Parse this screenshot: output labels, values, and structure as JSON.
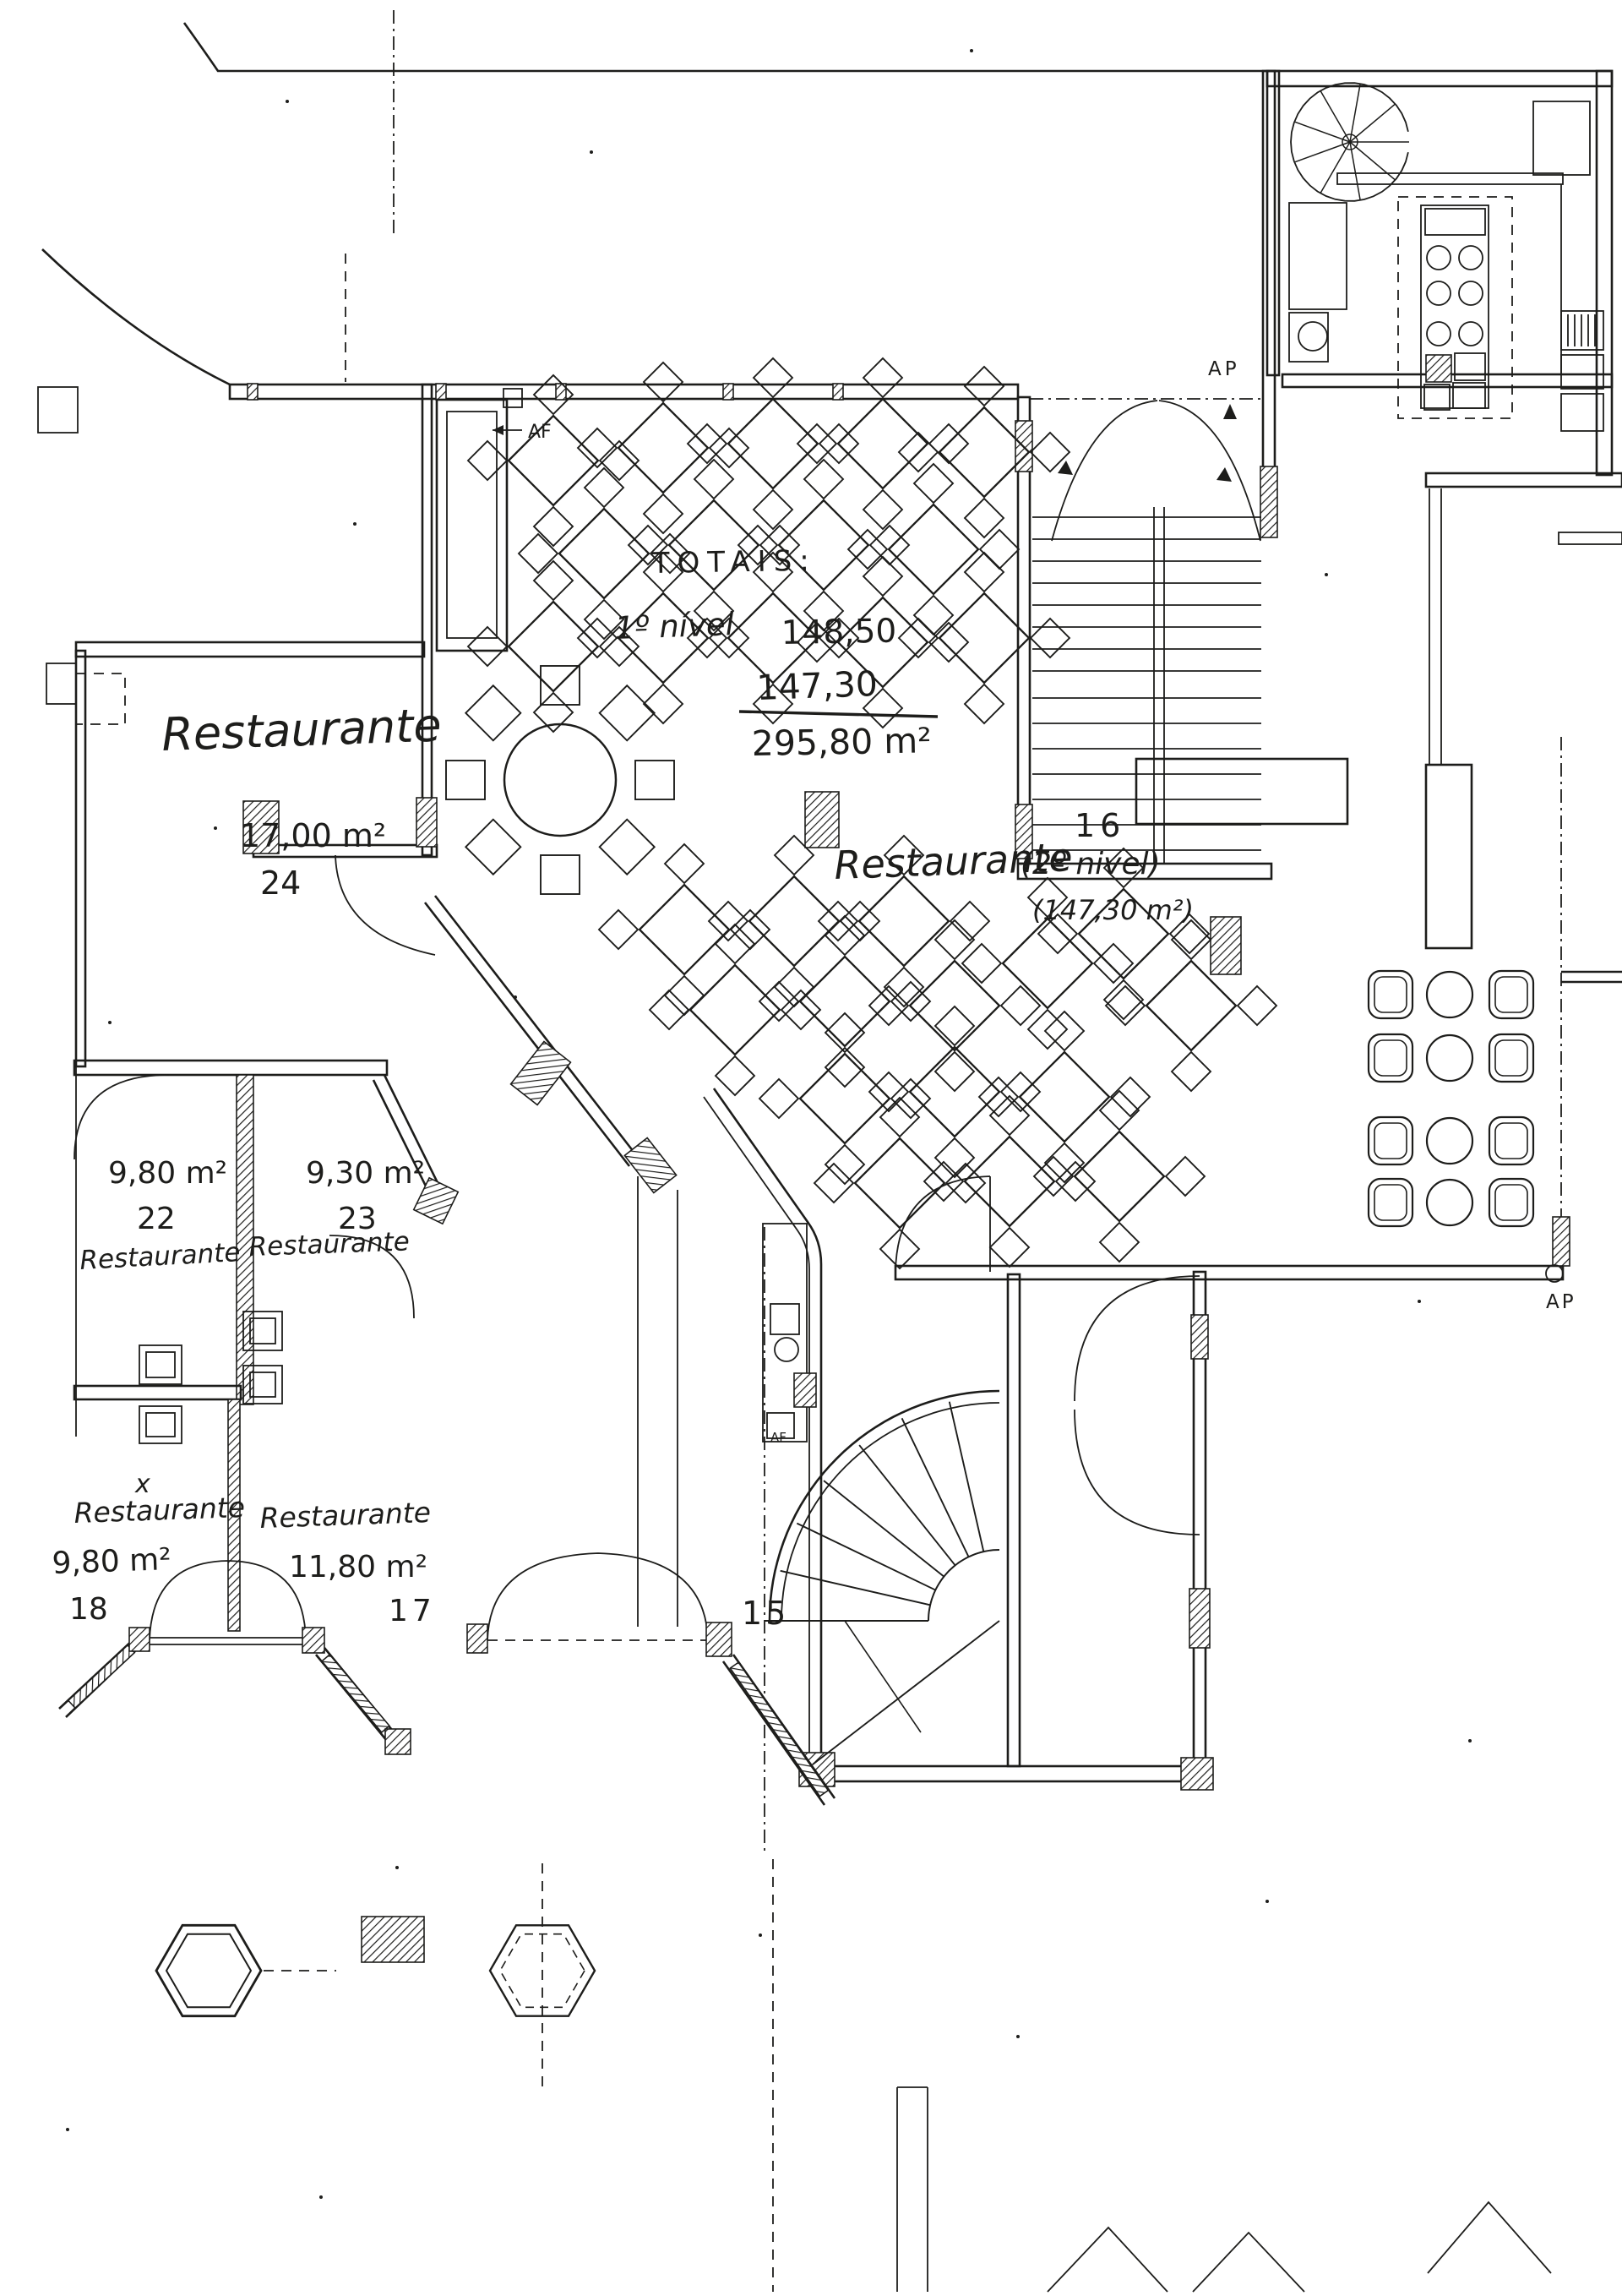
{
  "plan": {
    "paper_color": "#ffffff",
    "ink_color": "#1d1d1b",
    "totals": {
      "heading": "TOTAIS:",
      "level1_label": "1º nível",
      "level1_value": "148,50",
      "level2_value": "147,30",
      "total_value": "295,80 m²"
    },
    "rooms": [
      {
        "name": "Restaurante",
        "area": "17,00 m²",
        "number": "24"
      },
      {
        "name": "Restaurante",
        "level": "(2º nivel)",
        "area": "(147,30 m²)",
        "number": "16"
      },
      {
        "name": "Restaurante",
        "area": "9,80 m²",
        "number": "22"
      },
      {
        "name": "Restaurante",
        "area": "9,30 m²",
        "number": "23"
      },
      {
        "name": "Restaurante",
        "area": "9,80 m²",
        "number": "18"
      },
      {
        "name": "Restaurante",
        "area": "11,80 m²",
        "number": "17"
      },
      {
        "number": "15"
      }
    ],
    "annotations": {
      "ap_top": "AP",
      "af_dining": "AF",
      "ap_right": "AP",
      "af_counter": "AF",
      "x_mark": "x"
    }
  }
}
